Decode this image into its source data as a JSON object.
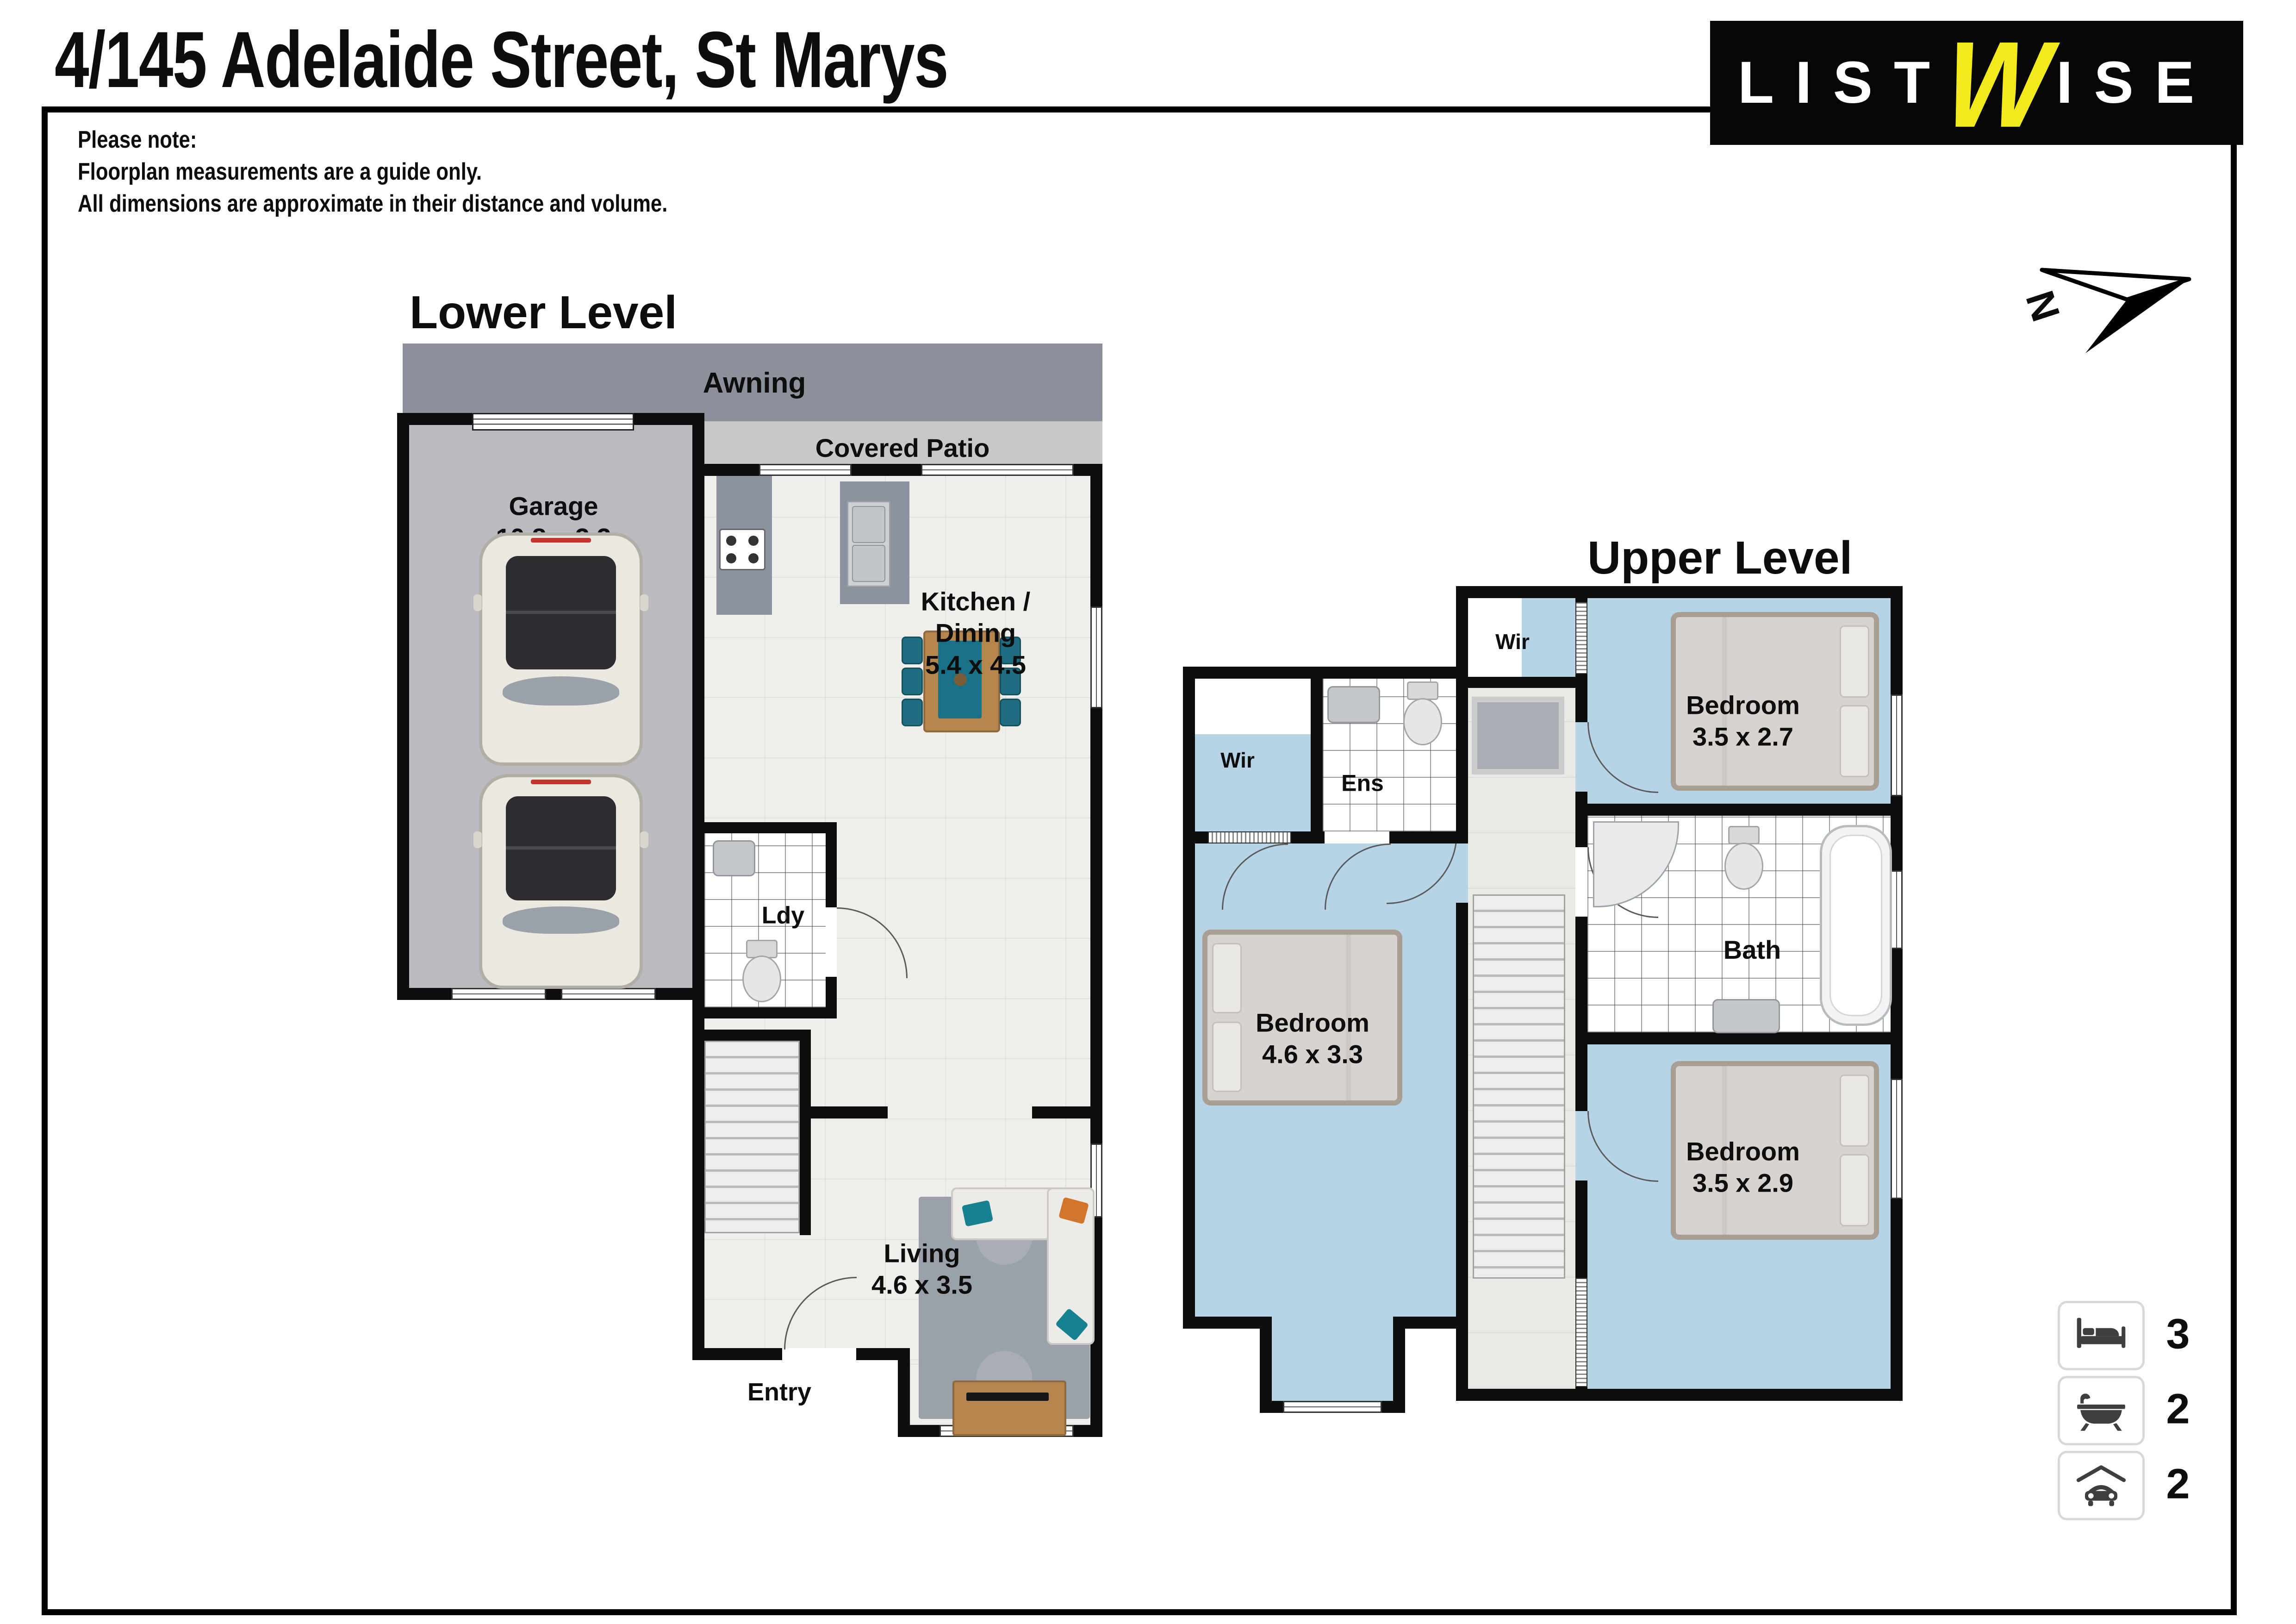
{
  "page": {
    "title": "4/145 Adelaide Street, St Marys",
    "note": "Please note:\nFloorplan measurements are a guide only.\nAll dimensions are approximate in their distance and volume."
  },
  "logo": {
    "part1": "LIST",
    "w": "W",
    "part2": "ISE",
    "bg": "#060606",
    "accent": "#f2ea1b"
  },
  "compass": {
    "label": "N"
  },
  "lower": {
    "heading": "Lower Level",
    "awning": "Awning",
    "covered_patio": "Covered Patio",
    "garage_label": "Garage\n10.8 x 3.3",
    "kitchen_label": "Kitchen /\nDining\n5.4 x 4.5",
    "ldy": "Ldy",
    "living_label": "Living\n4.6 x 3.5",
    "entry": "Entry"
  },
  "upper": {
    "heading": "Upper Level",
    "wir_top": "Wir",
    "wir_left": "Wir",
    "ens": "Ens",
    "bath": "Bath",
    "bedroom1_label": "Bedroom\n3.5 x 2.7",
    "bedroom2_label": "Bedroom\n4.6 x 3.3",
    "bedroom3_label": "Bedroom\n3.5 x 2.9"
  },
  "summary": {
    "beds": "3",
    "baths": "2",
    "cars": "2"
  },
  "colors": {
    "wall": "#0d0d0d",
    "awning_gray": "#8b909a",
    "patio_gray": "#c7c8ca",
    "garage_gray": "#b9bbc0",
    "upper_floor_blue": "#b7d3e6",
    "teal_accent": "#1f6d80",
    "logo_yellow": "#f2ea1b"
  }
}
